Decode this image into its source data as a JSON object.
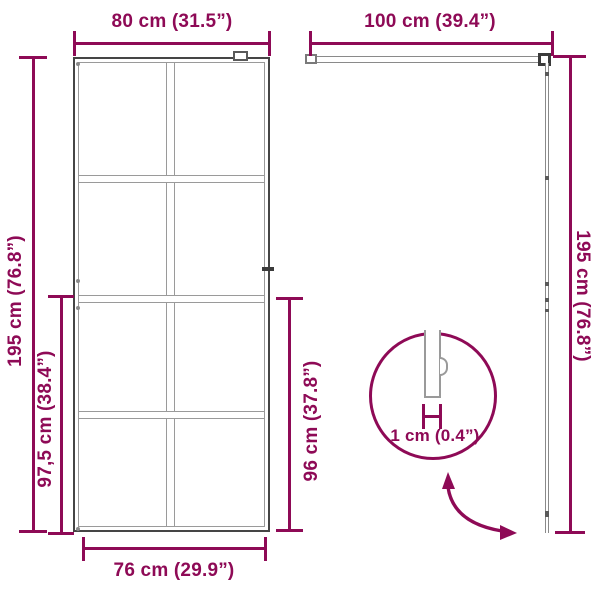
{
  "colors": {
    "accent": "#8E0A56",
    "frame_dark": "#454545",
    "frame_gray": "#9a9a9a"
  },
  "front_view": {
    "top_width_label": "80 cm (31.5”)",
    "height_label": "195 cm (76.8”)",
    "partial_height_left_label": "97,5 cm (38.4”)",
    "partial_height_right_label": "96 cm (37.8”)",
    "bottom_width_label": "76 cm (29.9”)"
  },
  "side_view": {
    "top_width_label": "100 cm (39.4”)",
    "height_label": "195 cm (76.8”)"
  },
  "detail_view": {
    "thickness_label": "1 cm (0.4”)"
  }
}
